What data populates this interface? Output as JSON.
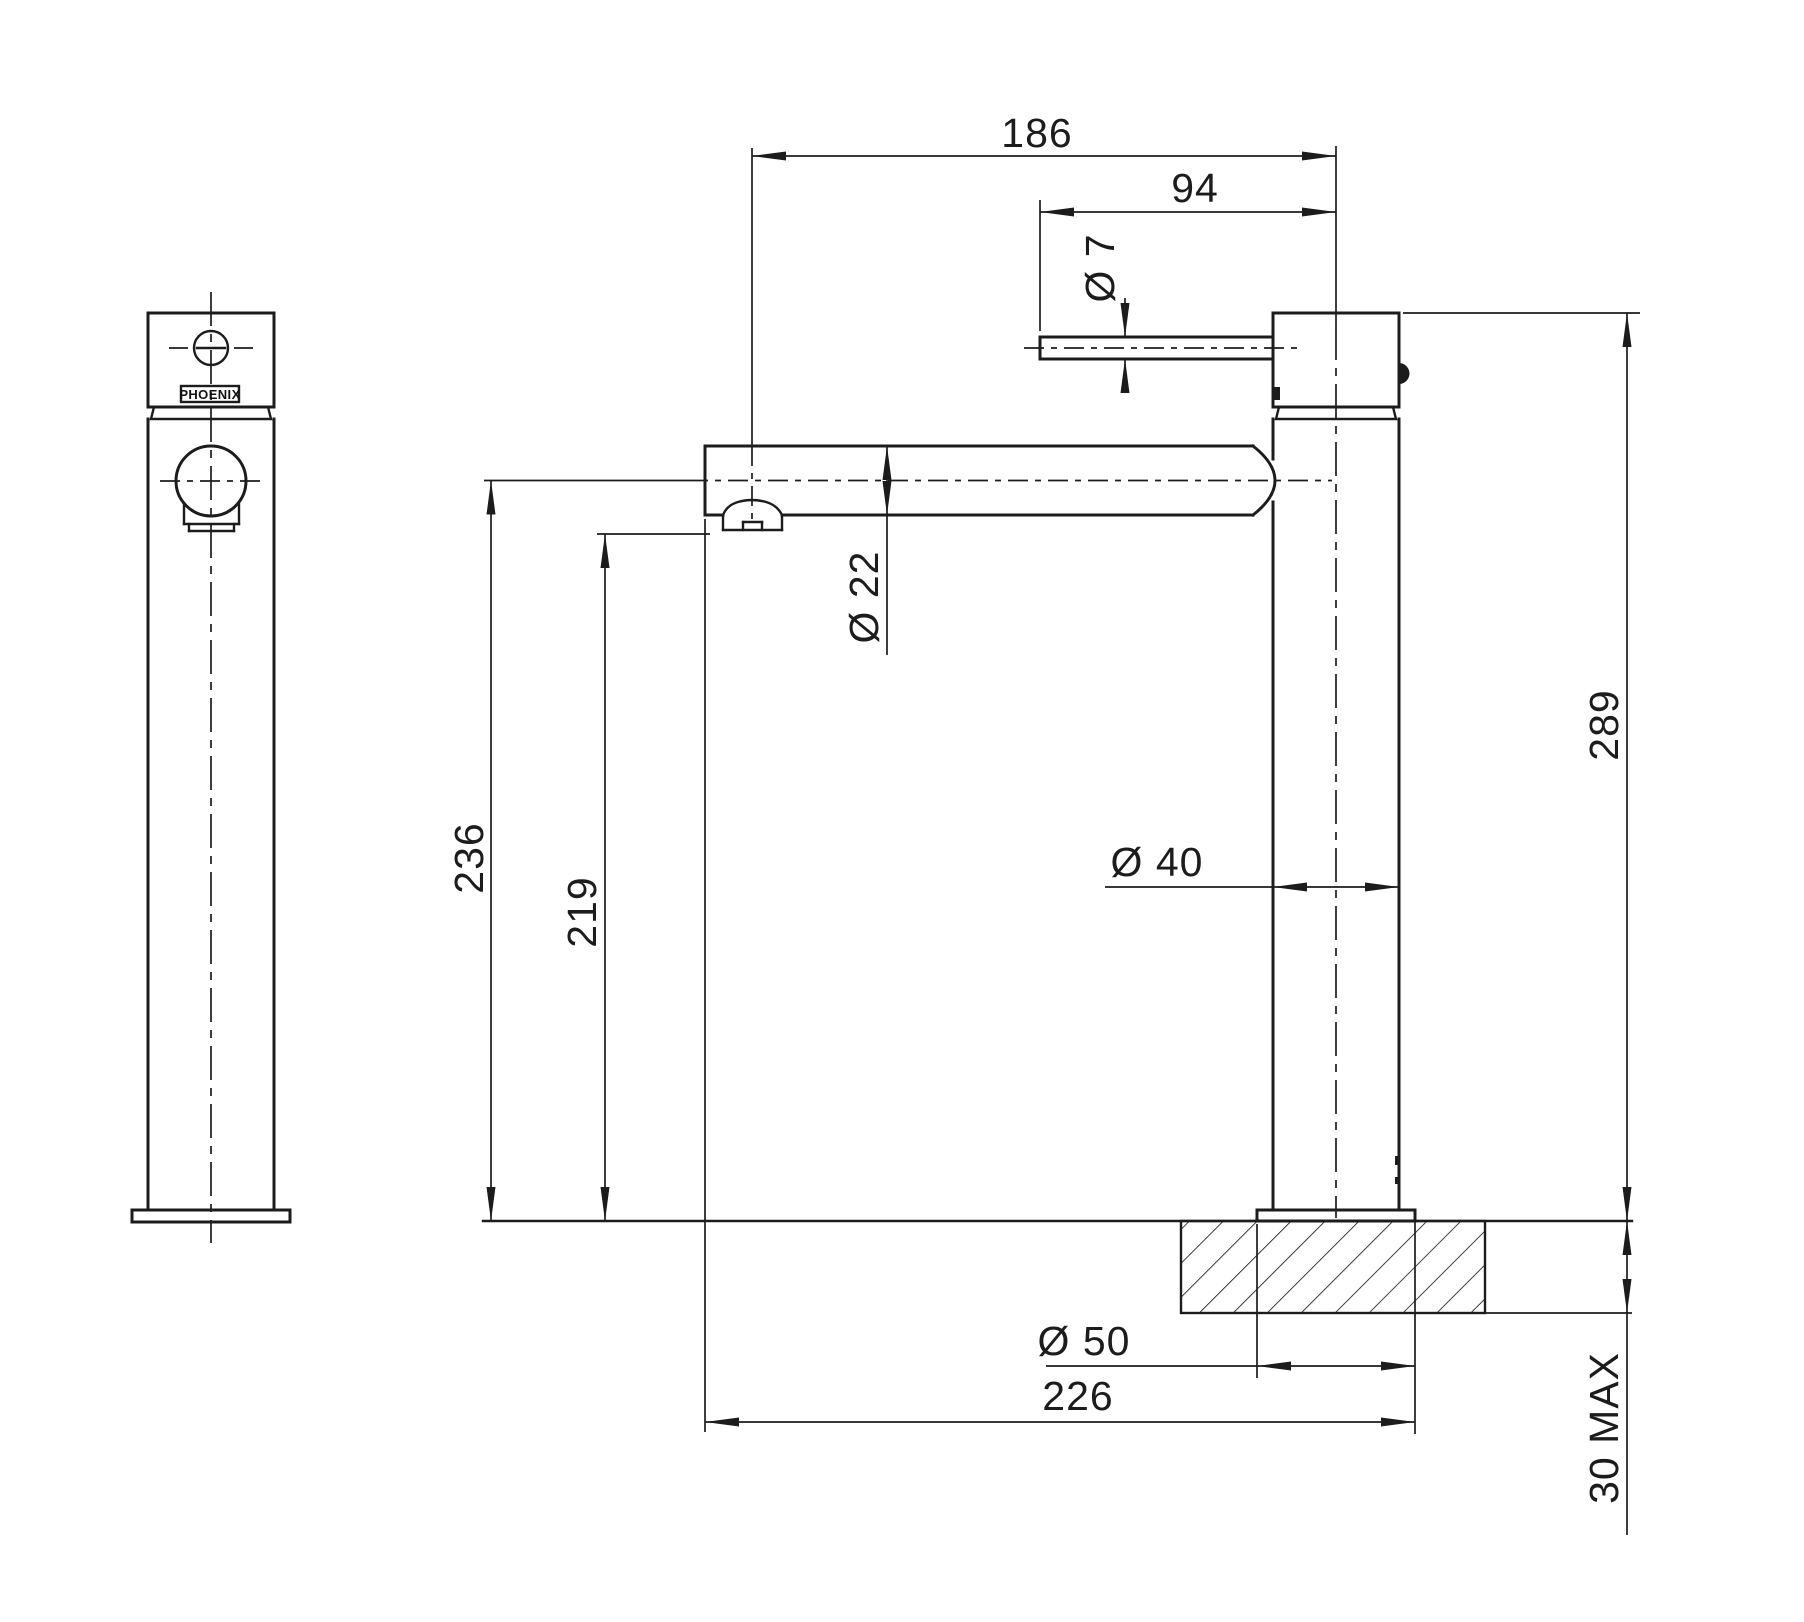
{
  "drawing": {
    "type": "technical-dimension-drawing",
    "subject": "tall basin mixer tap, front and side elevation views",
    "line_color": "#1c1c1c",
    "background_color": "#ffffff",
    "brand": {
      "logo": "PHOENIX"
    },
    "dimensions": {
      "reach_to_outlet": "186",
      "handle_length": "94",
      "handle_diameter": "Ø 7",
      "spout_diameter": "Ø 22",
      "body_diameter": "Ø 40",
      "base_diameter": "Ø 50",
      "overall_projection": "226",
      "height_to_spout_centre": "236",
      "height_to_outlet": "219",
      "overall_height": "289",
      "mounting_thickness": "30 MAX"
    }
  }
}
